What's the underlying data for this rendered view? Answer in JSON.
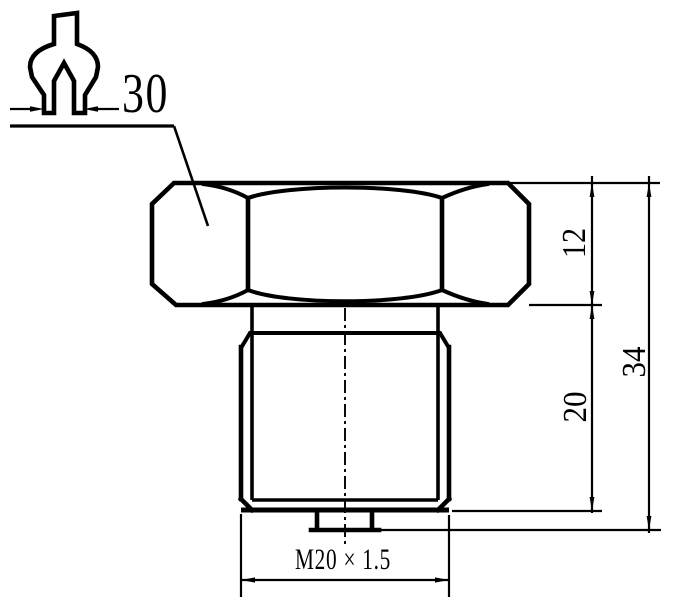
{
  "page": {
    "background_color": "#ffffff",
    "line_color": "#000000"
  },
  "drawing": {
    "type": "mechanical-part-drawing",
    "part": "hex-head-bolt-side-view",
    "icons": [
      "wrench-icon"
    ],
    "dimensions": {
      "wrench_size": "30",
      "head_height": "12",
      "thread_length": "20",
      "total_length": "34",
      "thread_spec": "M20 × 1.5"
    }
  }
}
